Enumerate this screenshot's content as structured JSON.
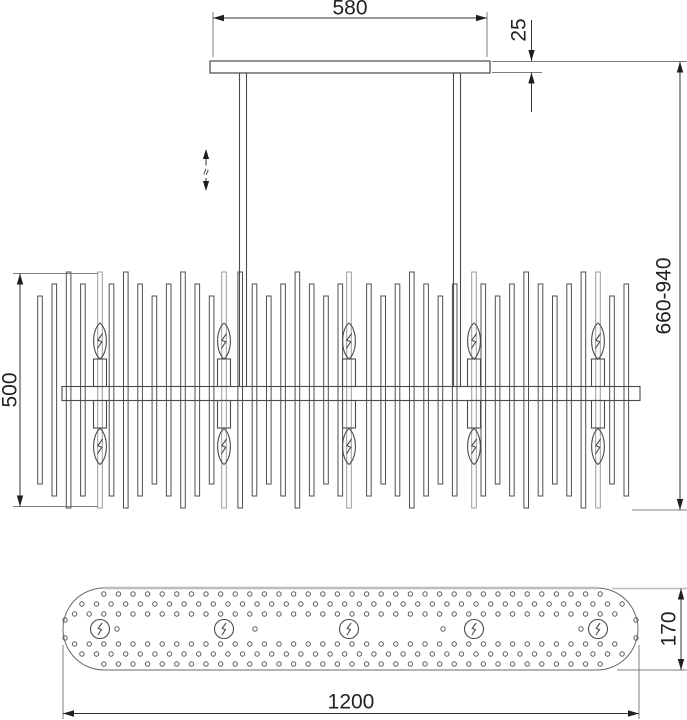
{
  "view": "chandelier-technical-dimension-drawing",
  "dimensions": {
    "top_width": "580",
    "canopy_thickness": "25",
    "overall_height": "660-940",
    "body_height": "500",
    "body_depth": "170",
    "body_width": "1200"
  },
  "symbols": {
    "height_adjustable": "≈"
  },
  "colors": {
    "line": "#4a4a4a",
    "dim_line": "#333333",
    "light_edge": "#bdbdbd",
    "gray_rod": "#9c9c9c"
  },
  "drawing": {
    "canvas": {
      "w": 687,
      "h": 720
    },
    "front": {
      "plate": {
        "x": 210,
        "y": 61,
        "w": 280,
        "h": 12
      },
      "hangers": [
        239.5,
        453.5
      ],
      "hanger_w": 7,
      "hanger_top": 73,
      "hanger_bottom": 386.5,
      "band": {
        "x": 62,
        "y": 386.5,
        "w": 578,
        "h": 14
      },
      "rods": {
        "x0": 40,
        "step": 14.3,
        "count": 42,
        "width": 4.6,
        "pattern": [
          "short",
          "med",
          "tall",
          "med"
        ],
        "tops": {
          "short": 296,
          "med": 284,
          "tall": 272
        },
        "bottoms": {
          "short": 484,
          "med": 496,
          "tall": 508
        }
      },
      "bulbs_x": [
        100,
        224,
        349,
        474,
        598
      ],
      "bulb": {
        "tube_w": 13,
        "upper_tube_top": 359,
        "upper_flame_cy": 341,
        "lower_tube_bottom": 428,
        "lower_flame_cy": 446.5,
        "flame_rx": 8.5,
        "flame_ry": 18,
        "backdrop_top": 272,
        "backdrop_bottom": 508
      },
      "adjust_x": 206
    },
    "bottom": {
      "stadium": {
        "x": 63,
        "y": 588,
        "w": 575,
        "h": 82,
        "r": 41
      },
      "cy": 629,
      "dot_r": 2.2,
      "grid": {
        "x0": 60,
        "step": 14.6,
        "count": 41
      },
      "rows": [
        {
          "y": 594,
          "off": 0
        },
        {
          "y": 604,
          "off": 7.3
        },
        {
          "y": 614,
          "off": 0
        },
        {
          "y": 644,
          "off": 0
        },
        {
          "y": 654,
          "off": 7.3
        },
        {
          "y": 664,
          "off": 0
        }
      ],
      "clearance": 35.5,
      "stray_dots": [
        [
          117,
          629
        ],
        [
          255,
          629
        ],
        [
          443,
          629
        ],
        [
          581,
          629
        ],
        [
          65,
          620
        ],
        [
          65,
          638
        ],
        [
          636,
          620
        ],
        [
          636,
          638
        ]
      ],
      "bulb_r": 9.5
    }
  }
}
